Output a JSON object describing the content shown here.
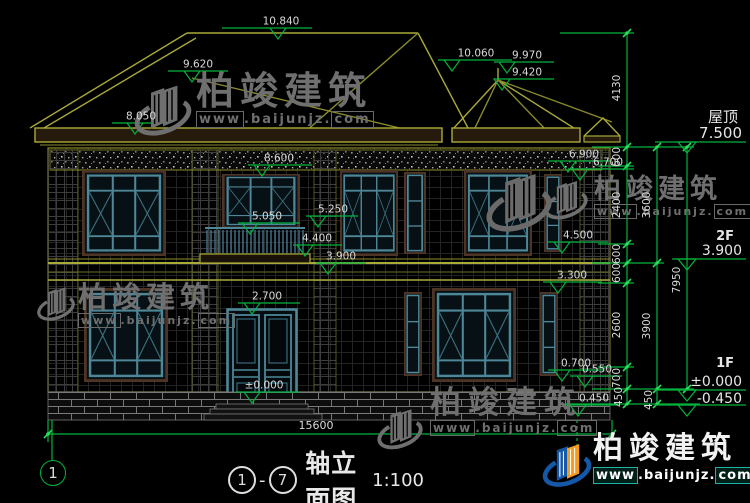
{
  "watermark": {
    "brand": "柏竣建筑",
    "url_www": "www",
    "url_mid": ".baijunjz.",
    "url_com": "com"
  },
  "levels": {
    "v10840": "10.840",
    "v9620": "9.620",
    "v8050": "8.050",
    "v10060": "10.060",
    "v9970": "9.970",
    "v9420": "9.420",
    "v8600": "8.600",
    "v6900": "6.900",
    "v6700": "6.700",
    "v5050": "5.050",
    "v5250": "5.250",
    "v4400": "4.400",
    "v3900": "3.900",
    "v4500": "4.500",
    "v3300": "3.300",
    "v2700": "2.700",
    "ground": "±0.000",
    "v0700": "0.700",
    "v0550": "0.550",
    "v0450": "0.450"
  },
  "vdims": {
    "v4130": "4130",
    "a1": "600",
    "a2": "2400",
    "a3": "600",
    "a4": "600",
    "a5": "2600",
    "a6": "700",
    "a7": "450",
    "b1": "3600",
    "b2": "3900",
    "b3": "450",
    "c1": "7950"
  },
  "right_labels": {
    "roof_label": "屋顶",
    "roof_level": "7.500",
    "f2_label": "2F",
    "f2_level": "3.900",
    "f1_label": "1F",
    "f1_level": "±0.000",
    "below_level": "-0.450"
  },
  "bottom": {
    "total_width": "15600",
    "axis_bubble": "1",
    "title_axis_start": "1",
    "title_dash": "-",
    "title_axis_end": "7",
    "title_text": "轴立面图",
    "title_scale": "1:100"
  },
  "colors": {
    "dim_green": "#00b33c",
    "line_yellow": "#a9a93a",
    "window_teal": "#4d8798",
    "watermark_gray": "#6f6f6f"
  }
}
